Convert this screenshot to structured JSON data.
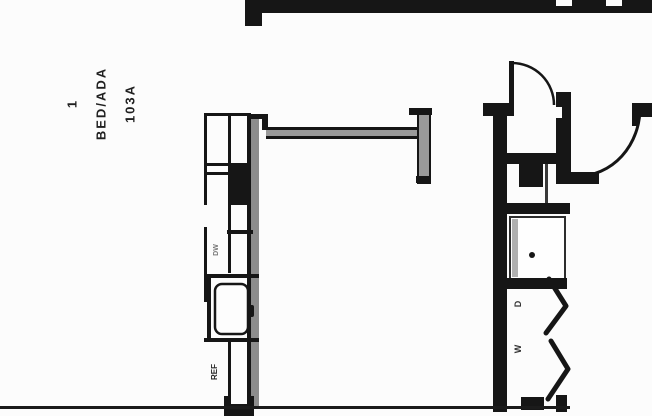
{
  "labels": {
    "unit": {
      "line1": "1",
      "line2": "BED/ADA",
      "line3": "103A"
    },
    "dishwasher": "DW",
    "refrigerator": "REF",
    "dryer": "D",
    "washer": "W"
  },
  "colors": {
    "ink": "#161616",
    "wall_gray": "#8d8d8d",
    "half_wall_gray": "#9a9a9a",
    "background": "#fcfcfc",
    "faint_text": "#777777"
  }
}
